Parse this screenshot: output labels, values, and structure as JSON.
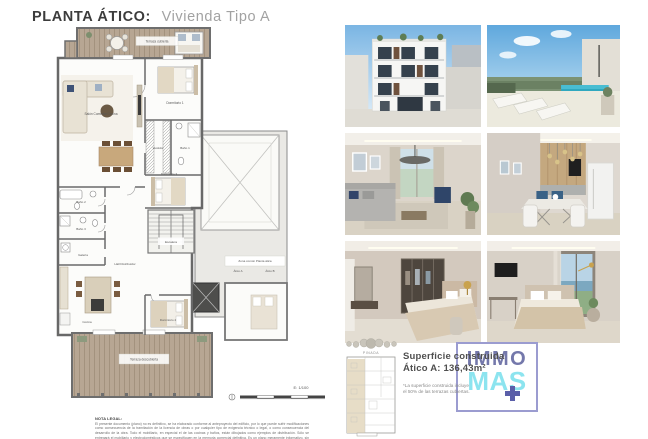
{
  "page": {
    "title_bold": "PLANTA ÁTICO:",
    "title_light": "Vivienda Tipo A"
  },
  "floorplan": {
    "rooms": {
      "terraza_cubierta": "Terraza cubierta",
      "dormitorio1": "Dormitorio 1",
      "salon": "Salón Comedor Cocina",
      "vestidor": "Vestidor",
      "bano1": "Baño 1",
      "dormitorio3": "Dormitorio 3",
      "bano2": "Baño 2",
      "bano3": "Baño 3",
      "galeria": "Galería",
      "escalera": "Escalera",
      "hall": "Hall Distribuidor",
      "zona_comun": "Zona común Planta ática",
      "atico_a": "Ático A",
      "atico_b": "Ático B",
      "cocina": "Cocina",
      "dormitorio2": "Dormitorio 2",
      "terraza_descubierta": "Terraza descubierta"
    },
    "scale": "E: 1/100"
  },
  "legal": {
    "heading": "NOTA LEGAL:",
    "body": "El presente documento (plano) no es definitivo, se ha elaborado conforme al anteproyecto del edificio, por lo que puede sufrir modificaciones como consecuencia de la tramitación de la licencia de obras o por cualquier tipo de exigencia técnico o legal, o como consecuencia del desarrollo de la obra. Todo el mobiliario, en especial el de las cocinas y baños, están dibujados como ejemplos de distribución. Sólo se entregará el mobiliario y electrodomésticos que se especifiquen en la memoria comercial definitiva. Es un plano meramente informativo, sin contenido contractual."
  },
  "keyplan": {
    "label": "PINADA"
  },
  "summary": {
    "line1": "Superficie construida",
    "line2": "Ático A: 136,43m²",
    "footnote": "*La superficie construida incluye el 50% de las terrazas cubiertas."
  },
  "logo": {
    "top": "IMMO",
    "bottom": "MAS"
  },
  "colors": {
    "logo_immo": "#7478ab",
    "logo_mas": "#8ce4ef",
    "logo_plus": "#5b5fa9",
    "logo_border": "#9b9cd0",
    "terrace_wood": "#b7a693"
  },
  "photos": [
    {
      "name": "building-facade-render"
    },
    {
      "name": "rooftop-terrace-pool-render"
    },
    {
      "name": "living-room-render"
    },
    {
      "name": "dining-kitchen-render"
    },
    {
      "name": "master-bedroom-dressing-render"
    },
    {
      "name": "bedroom-sea-view-render"
    }
  ]
}
